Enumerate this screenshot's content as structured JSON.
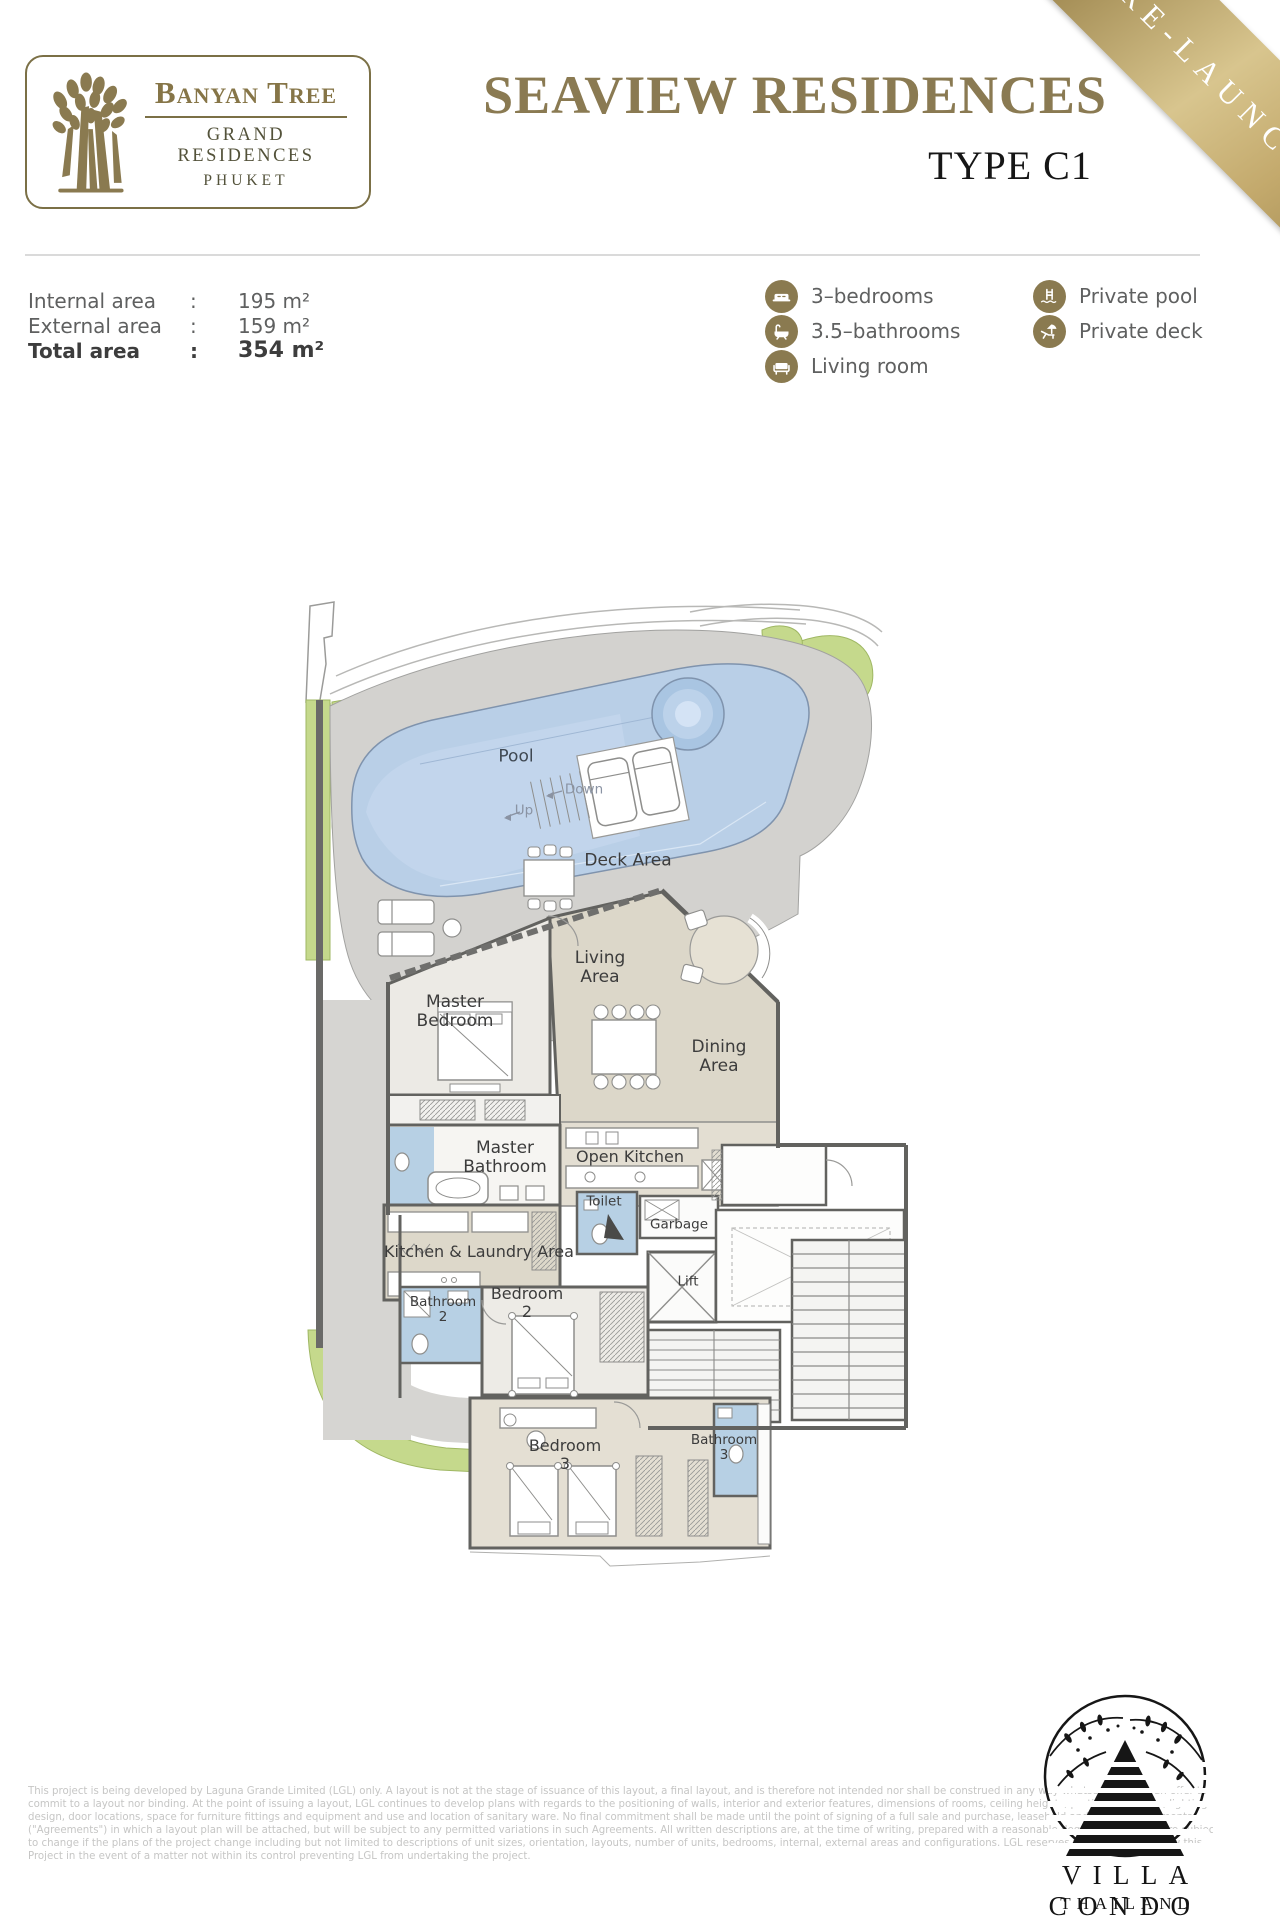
{
  "header": {
    "logo": {
      "brand": "Banyan Tree",
      "line2": "GRAND RESIDENCES",
      "line3": "PHUKET"
    },
    "title": "SEAVIEW RESIDENCES",
    "subtitle": "TYPE C1",
    "ribbon": "PRE-LAUNCH"
  },
  "areas": {
    "rows": [
      {
        "label": "Internal area",
        "sep": ":",
        "value": "195 m²"
      },
      {
        "label": "External area",
        "sep": ":",
        "value": "159 m²"
      },
      {
        "label": "Total area",
        "sep": ":",
        "value": "354 m²"
      }
    ]
  },
  "features": {
    "col1": [
      {
        "icon": "bed-icon",
        "label": "3–bedrooms"
      },
      {
        "icon": "bathtub-icon",
        "label": "3.5–bathrooms"
      },
      {
        "icon": "sofa-icon",
        "label": "Living room"
      }
    ],
    "col2": [
      {
        "icon": "pool-ladder-icon",
        "label": "Private pool"
      },
      {
        "icon": "deck-chair-icon",
        "label": "Private deck"
      }
    ]
  },
  "floorplan": {
    "labels": [
      {
        "text": "Pool"
      },
      {
        "text": "Up"
      },
      {
        "text": "Down"
      },
      {
        "text": "Deck Area"
      },
      {
        "text": "Living\nArea"
      },
      {
        "text": "Master\nBedroom"
      },
      {
        "text": "Dining\nArea"
      },
      {
        "text": "Master\nBathroom"
      },
      {
        "text": "Open Kitchen"
      },
      {
        "text": "Toilet"
      },
      {
        "text": "Garbage"
      },
      {
        "text": "Kitchen & Laundry Area"
      },
      {
        "text": "Lift"
      },
      {
        "text": "Bathroom\n2"
      },
      {
        "text": "Bedroom\n2"
      },
      {
        "text": "Bedroom\n3"
      },
      {
        "text": "Bathroom\n3"
      }
    ]
  },
  "disclaimer": {
    "lines": [
      "This project is being developed by Laguna Grande Limited (LGL) only. A layout is not at the stage of issuance of this layout, a final layout, and is therefore not intended nor shall be construed in any way whatsoever to be an offer to",
      "commit to a layout nor binding. At the point of issuing a layout, LGL continues to develop plans with regards to the positioning of walls, interior and exterior features, dimensions of rooms, ceiling heights, partition locations, lighting",
      "design, door locations, space for furniture fittings and equipment and use and location of sanitary ware. No final commitment shall be made until the point of signing of a full sale and purchase, leasehold and related agreements",
      "(\"Agreements\") in which a layout plan will be attached, but will be subject to any permitted variations in such Agreements. All written descriptions are, at the time of writing, prepared with a reasonable degree of care, but are subject",
      "to change if the plans of the project change including but not limited to descriptions of unit sizes, orientation, layouts, number of units, bedrooms, internal, external areas and configurations. LGL reserves the right to withdraw this",
      "Project in the event of a matter not within its control preventing LGL from undertaking the project."
    ]
  },
  "footer_logo": {
    "name": "VILLA CONDO",
    "country": "THAILAND"
  },
  "colors": {
    "brand_gold": "#8a7a52",
    "icon_gold": "#8a7a50",
    "pool_blue": "#b9cfe7",
    "bath_blue": "#b7d0e4",
    "planter_green": "#c5d98c",
    "deck_gray": "#d3d2cf",
    "interior_beige": "#dcd7c9",
    "text_gray": "#5f6060"
  }
}
